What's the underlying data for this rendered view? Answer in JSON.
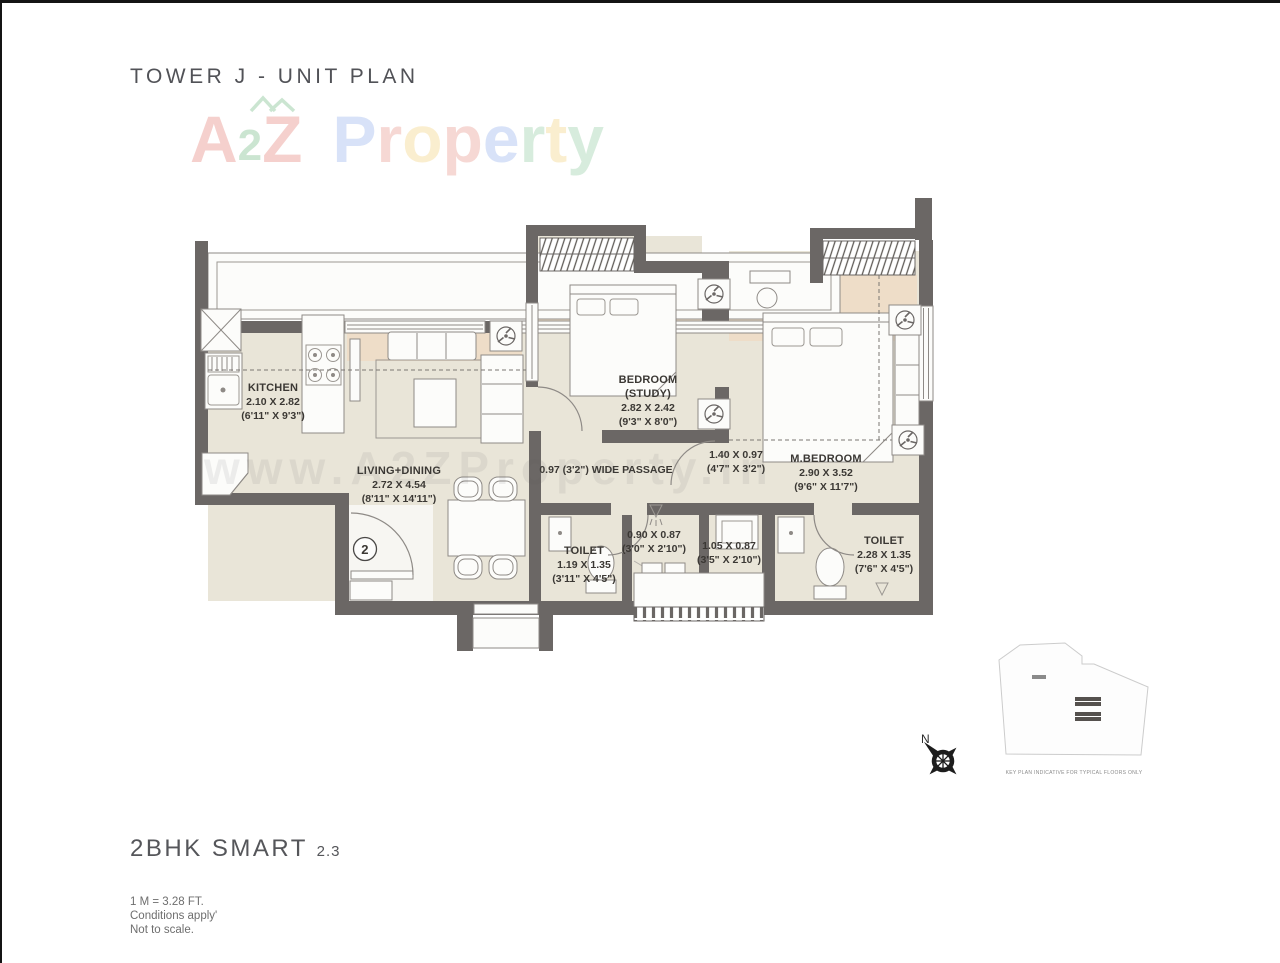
{
  "page": {
    "title": "TOWER J - UNIT PLAN",
    "plan_name": "2BHK SMART",
    "plan_variant": "2.3",
    "footnotes": [
      "1 M = 3.28 FT.",
      "Conditions apply'",
      "Not to scale."
    ]
  },
  "watermark": {
    "brand": [
      {
        "ch": "A",
        "color": "#d94f43"
      },
      {
        "ch": "2",
        "color": "#3c9e52"
      },
      {
        "ch": "Z",
        "color": "#d94f43"
      },
      {
        "ch": "P",
        "color": "#6a92e5"
      },
      {
        "ch": "r",
        "color": "#e06a5e"
      },
      {
        "ch": "o",
        "color": "#efc04a"
      },
      {
        "ch": "p",
        "color": "#e06a5e"
      },
      {
        "ch": "e",
        "color": "#6a92e5"
      },
      {
        "ch": "r",
        "color": "#69b97e"
      },
      {
        "ch": "t",
        "color": "#efc04a"
      },
      {
        "ch": "y",
        "color": "#69b97e"
      }
    ],
    "url": "www.A2ZProperty.in"
  },
  "rooms": {
    "kitchen": {
      "name": "KITCHEN",
      "dim_m": "2.10 X 2.82",
      "dim_ft": "(6'11\" X 9'3\")"
    },
    "living_dining": {
      "name": "LIVING+DINING",
      "dim_m": "2.72 X 4.54",
      "dim_ft": "(8'11\" X 14'11\")"
    },
    "bedroom_study": {
      "name": "BEDROOM",
      "subname": "(STUDY)",
      "dim_m": "2.82 X 2.42",
      "dim_ft": "(9'3\" X 8'0\")"
    },
    "master_bedroom": {
      "name": "M.BEDROOM",
      "dim_m": "2.90 X 3.52",
      "dim_ft": "(9'6\" X 11'7\")"
    },
    "toilet_common": {
      "name": "TOILET",
      "dim_m": "1.19 X 1.35",
      "dim_ft": "(3'11\" X 4'5\")"
    },
    "toilet_master": {
      "name": "TOILET",
      "dim_m": "2.28 X 1.35",
      "dim_ft": "(7'6\" X 4'5\")"
    },
    "shower_area": {
      "dim_m": "0.90 X 0.87",
      "dim_ft": "(3'0\" X 2'10\")"
    },
    "utility_area": {
      "dim_m": "1.05 X 0.87",
      "dim_ft": "(3'5\" X 2'10\")"
    },
    "passage": {
      "label": "0.97 (3'2\") WIDE PASSAGE"
    },
    "passage_lobby": {
      "dim_m": "1.40 X 0.97",
      "dim_ft": "(4'7\" X 3'2\")"
    }
  },
  "entrance": {
    "door_number": "2"
  },
  "key_plan": {
    "caption": "KEY PLAN INDICATIVE FOR TYPICAL FLOORS ONLY",
    "compass_north_label": "N"
  },
  "colors": {
    "wall": "#6b6765",
    "floor": "#e9e5d8",
    "accent": "#eeddc8"
  }
}
